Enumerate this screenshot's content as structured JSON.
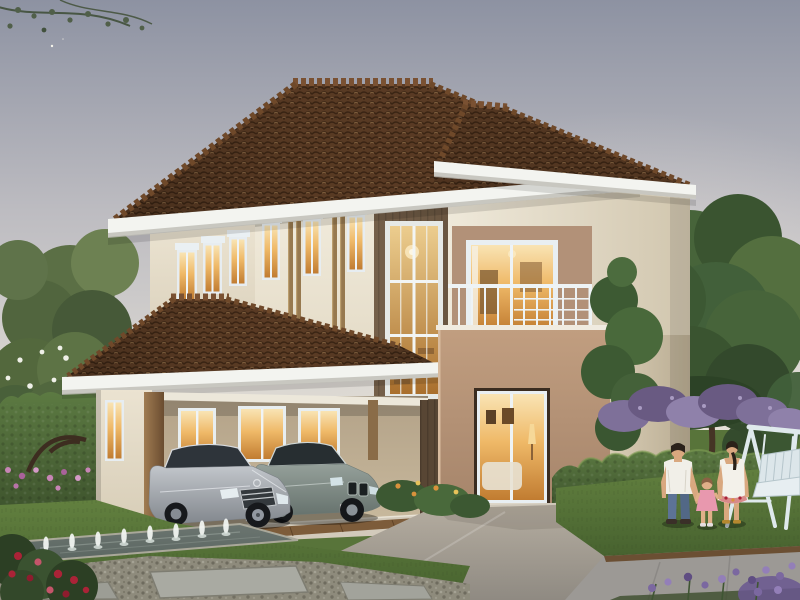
{
  "scene": {
    "subject": "Two-story suburban house exterior rendering at dusk",
    "sky": {
      "condition": "overcast dusk",
      "stars_visible": 1
    },
    "house": {
      "stories": 2,
      "roof": {
        "style": "hip",
        "material": "clay tile"
      },
      "second_floor": {
        "left_wall_windows": 3,
        "front_narrow_windows": 3,
        "stairwell_window_grid": "2x3",
        "balcony": {
          "railing": "white metal",
          "door": "sliding glass"
        }
      },
      "first_floor": {
        "carport_windows": 3,
        "side_window": 1,
        "entry": "recessed sliding glass door",
        "carport_vehicles": 2
      }
    },
    "vehicles": [
      {
        "type": "sedan",
        "color_name": "silver"
      },
      {
        "type": "sedan",
        "color_name": "gray-green"
      }
    ],
    "people": [
      {
        "label": "man",
        "clothing": "white shirt, blue jeans"
      },
      {
        "label": "child",
        "clothing": "pink dress"
      },
      {
        "label": "woman",
        "clothing": "white dress"
      }
    ],
    "garden": {
      "fountain_jets": 8,
      "features": [
        "trimmed hedges",
        "white-blossom tree",
        "large green tree",
        "purple shrubs",
        "rose bush",
        "reflecting water strip",
        "pebble bed with stepping stones",
        "driveway",
        "walkway",
        "white swing bench"
      ]
    }
  },
  "palette": {
    "sky_top": "#8d92a2",
    "sky_mid": "#bdbcc1",
    "sky_horizon": "#e7e1d7",
    "roof_tile": "#5a3b24",
    "roof_line": "#3b2514",
    "fascia": "#f3f4f0",
    "wall_cream": "#f2ecdd",
    "wall_shadow": "#d9d0bc",
    "accent_beam": "#b2905f",
    "accent_strip": "#97794f",
    "dark_wood": "#6a5641",
    "window_frame": "#e7edf1",
    "glow_light": "#f9e4b4",
    "glow_mid": "#efb968",
    "glow_deep": "#c17c31",
    "balcony_box": "#c19e80",
    "railing": "#eef3f5",
    "lawn": "#62803f",
    "lawn_dark": "#47622f",
    "hedge": "#5c7a42",
    "hedge_dark": "#3f552e",
    "tree_green": "#47643a",
    "driveway": "#b6aea1",
    "driveway_dark": "#8f8a82",
    "walkway": "#9c9995",
    "pebble": "#8e8b7c",
    "water": "#5c6762",
    "car_silver": "#c2c6cb",
    "car_gray": "#95a09a",
    "swing_white": "#e2eaee",
    "flower_red": "#aa2337",
    "flower_purple": "#7b68a0",
    "flower_pink": "#c785b5",
    "flower_orange": "#d9923c"
  }
}
